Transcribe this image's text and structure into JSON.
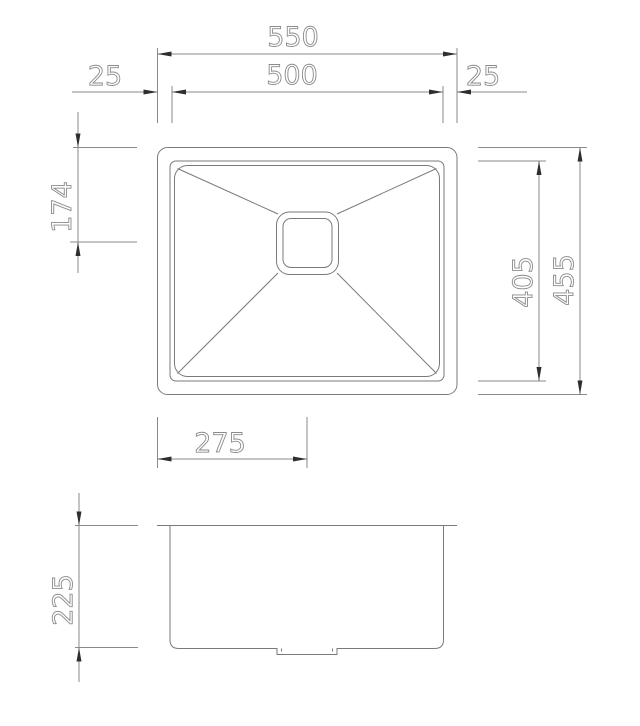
{
  "drawing": {
    "dimensions": {
      "overall_width": "550",
      "bowl_width": "500",
      "left_rim": "25",
      "right_rim": "25",
      "drain_from_top": "174",
      "bowl_depth": "405",
      "overall_depth": "455",
      "drain_from_left": "275",
      "bowl_height": "225"
    },
    "colors": {
      "background": "#ffffff",
      "outline_line": "#7a7a7a",
      "dimension_line": "#8a8a8a",
      "arrow": "#2e2e2e",
      "label_text": "#8b8b8b"
    }
  }
}
